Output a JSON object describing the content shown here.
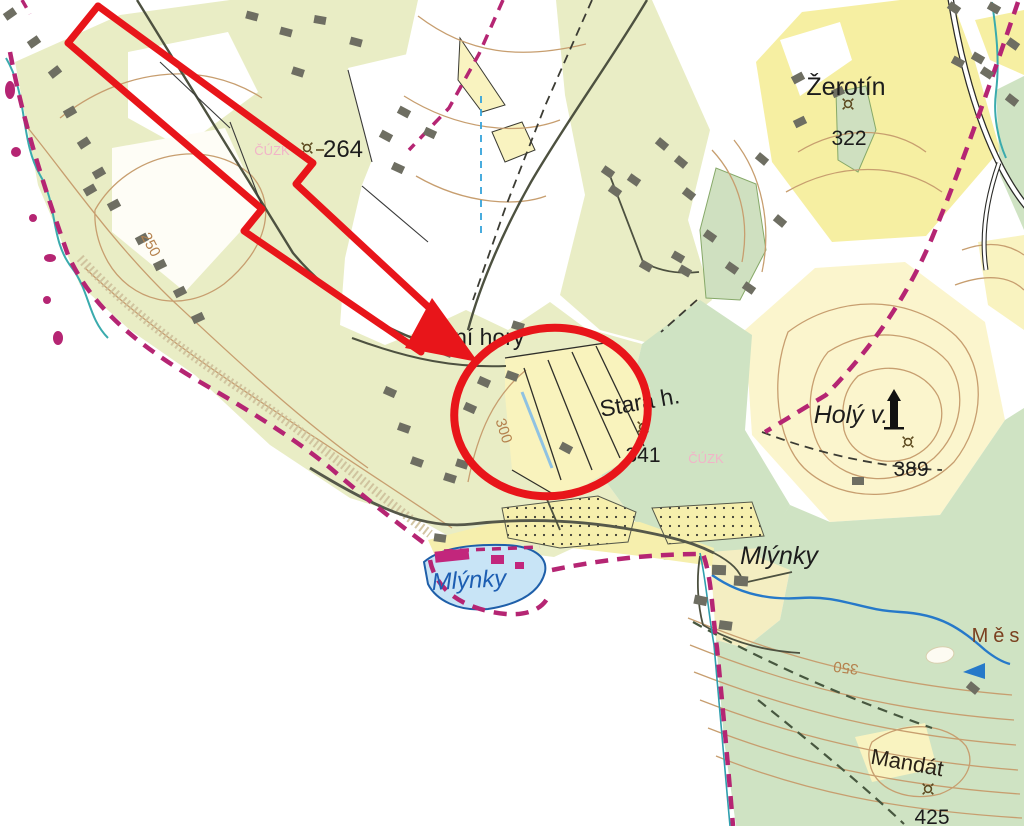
{
  "map": {
    "type": "topographic-cadastral-map",
    "labels": {
      "zerotin": {
        "name": "Žerotín",
        "elevation": "322"
      },
      "hill_264": {
        "elevation": "264"
      },
      "dolni_hory": {
        "name": "Dolní hory"
      },
      "stara_h": {
        "name": "Stará h.",
        "elevation": "341"
      },
      "holy_v": {
        "name": "Holý v.",
        "elevation": "389"
      },
      "mlynky_pond": {
        "name": "Mlýnky"
      },
      "mlynky_village": {
        "name": "Mlýnky"
      },
      "mestsky": {
        "name": "Měs"
      },
      "mandat": {
        "name": "Mandát",
        "elevation": "425"
      },
      "contour_250": "250",
      "contour_300": "300",
      "contour_350": "350",
      "watermark": "ČÚZK"
    },
    "icons": {
      "spot_height": "circle-with-diagonal-rays",
      "monument": "black-tower-silhouette",
      "stream_flow": "flow-direction-arrow"
    },
    "colors": {
      "annotation_red": "#e8151a",
      "boundary_magenta": "#b52573",
      "water_blue": "#2679c9",
      "stream_teal": "#3aabad",
      "pond_fill": "#c8e4f6",
      "pond_outline": "#1f5fa9",
      "field_yellow": "#f6efad",
      "meadow_green": "#e9edc5",
      "forest_green": "#cfe3c3",
      "contour_brown": "#c79e6f",
      "building_gray": "#6e6e62",
      "water_label_blue": "#1d5eb2"
    }
  }
}
